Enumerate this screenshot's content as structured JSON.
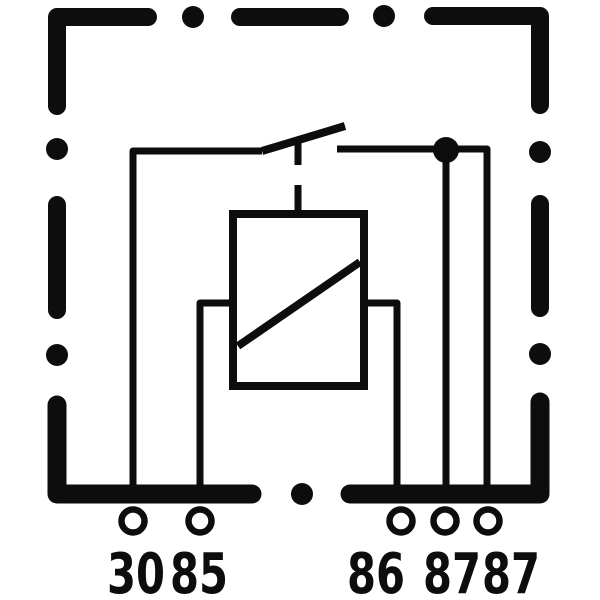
{
  "diagram": {
    "type": "relay-circuit-schematic",
    "colors": {
      "ink": "#0d0d0d",
      "background": "#ffffff"
    },
    "symbols": {
      "case_outline": "dashed-square-border",
      "coil": "rectangle-with-diagonal-stroke",
      "switch": "normally-open-contact-blade",
      "junction": "filled-connection-dot"
    },
    "terminals": [
      {
        "id": "30",
        "label": "30",
        "circle_x": 133,
        "label_x": 136
      },
      {
        "id": "85",
        "label": "85",
        "circle_x": 200,
        "label_x": 199
      },
      {
        "id": "86",
        "label": "86",
        "circle_x": 401,
        "label_x": 376
      },
      {
        "id": "87-1",
        "label": "87",
        "circle_x": 445,
        "label_x": 452
      },
      {
        "id": "87-2",
        "label": "87",
        "circle_x": 488,
        "label_x": 511
      }
    ]
  }
}
